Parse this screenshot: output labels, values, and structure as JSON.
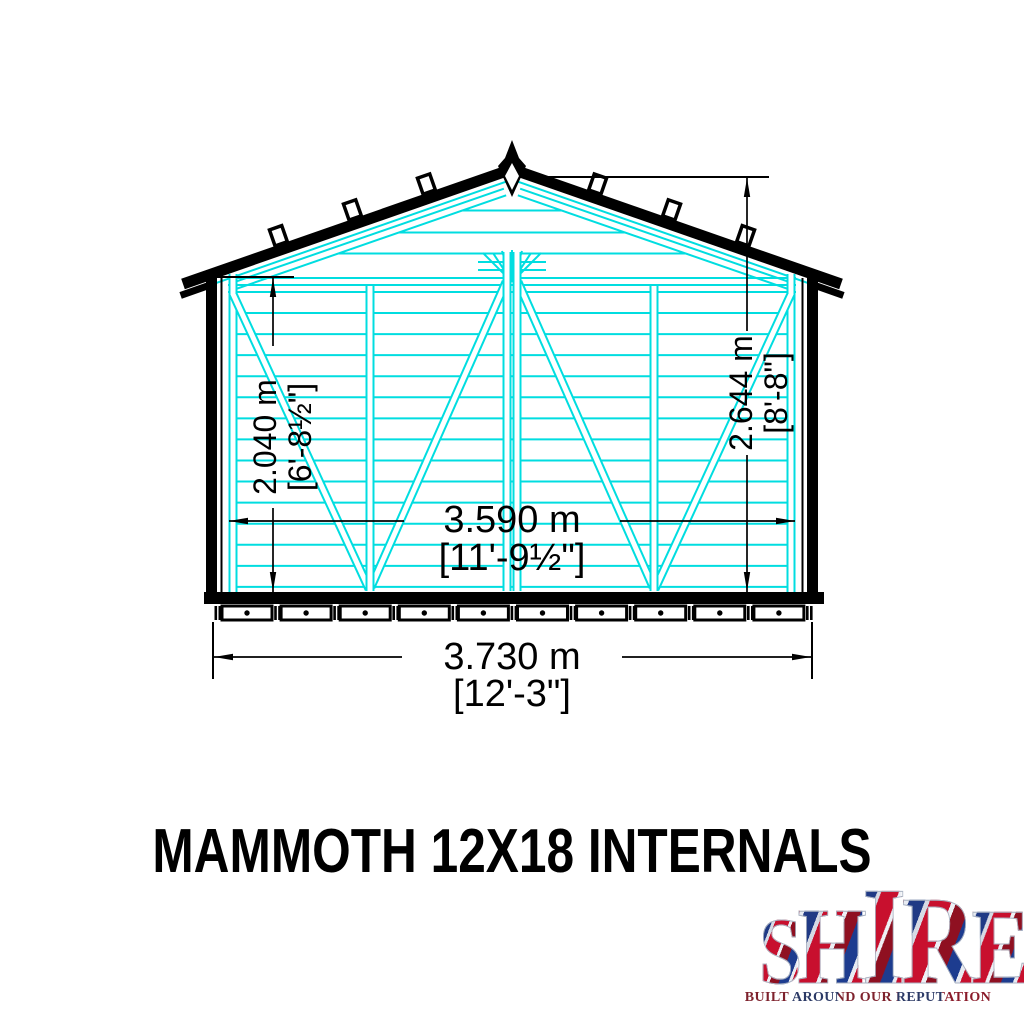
{
  "title": "MAMMOTH 12X18 INTERNALS",
  "drawing": {
    "type": "shed-gable-end-internal-elevation",
    "colors": {
      "framing": "#00dde0",
      "outline": "#000000"
    },
    "dimensions": {
      "wall_height": {
        "metric": "2.040 m",
        "imperial": "[6'-8½\"]"
      },
      "ridge_height": {
        "metric": "2.644 m",
        "imperial": "[8'-8\"]"
      },
      "internal_width": {
        "metric": "3.590 m",
        "imperial": "[11'-9½\"]"
      },
      "overall_width": {
        "metric": "3.730 m",
        "imperial": "[12'-3\"]"
      }
    }
  },
  "logo": {
    "word": "SHIRE",
    "letters": [
      "S",
      "H",
      "I",
      "R",
      "E"
    ],
    "tagline": "BUILT AROUND OUR REPUTATION",
    "colors": {
      "red": "#c8102e",
      "blue": "#1d3c8f",
      "silver": "#dfe3ea"
    }
  }
}
